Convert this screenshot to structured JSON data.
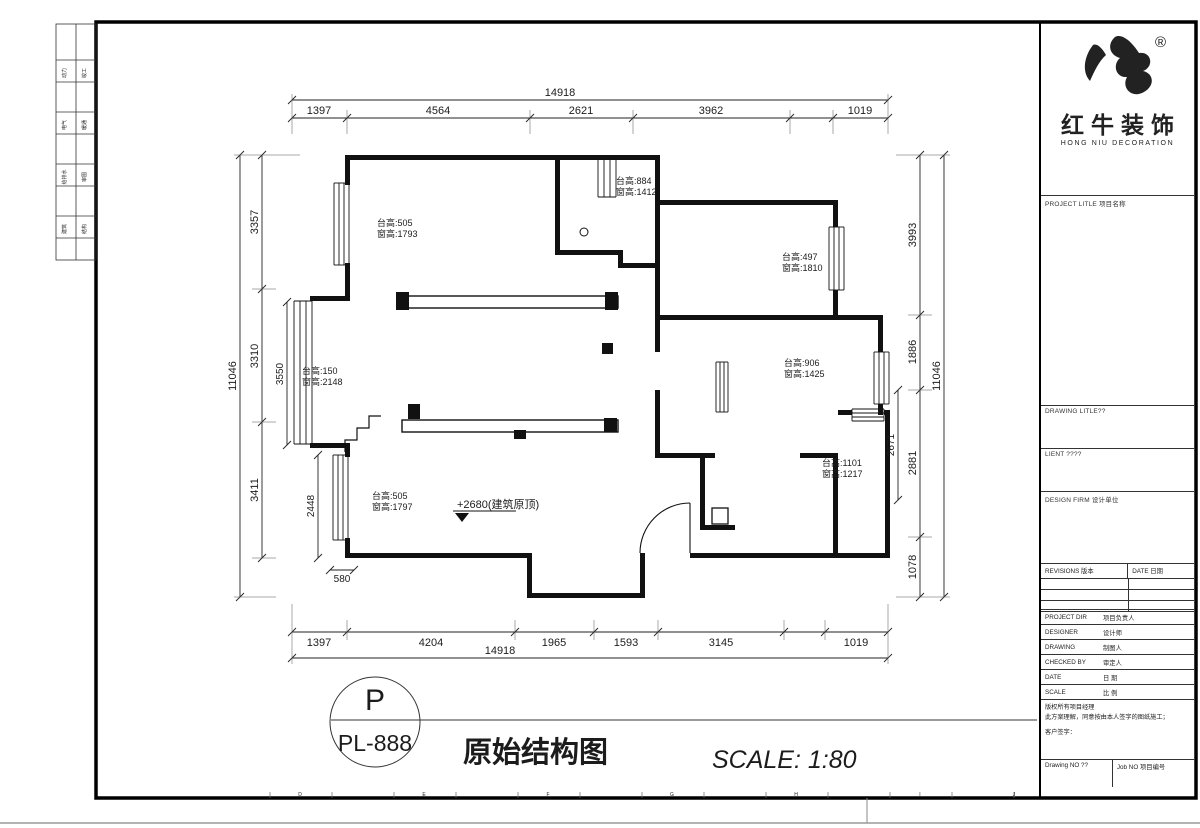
{
  "plan": {
    "dims": {
      "top_total": "14918",
      "top": [
        "1397",
        "4564",
        "2621",
        "3962",
        "1019"
      ],
      "bottom": [
        "1397",
        "4204",
        "1965",
        "1593",
        "3145",
        "1019"
      ],
      "bottom_total": "14918",
      "left_total": "11046",
      "left": [
        "3357",
        "3310",
        "3411"
      ],
      "left_inner_3550": "3550",
      "left_inner_2448": "2448",
      "left_inner_580": "580",
      "right_total": "11046",
      "right": [
        "3993",
        "1886",
        "2881",
        "1078"
      ],
      "right_inner_2671": "2671"
    },
    "notes": [
      {
        "l1": "台高:505",
        "l2": "窗高:1793"
      },
      {
        "l1": "台高:884",
        "l2": "窗高:1412"
      },
      {
        "l1": "台高:497",
        "l2": "窗高:1810"
      },
      {
        "l1": "台高:150",
        "l2": "窗高:2148"
      },
      {
        "l1": "台高:906",
        "l2": "窗高:1425"
      },
      {
        "l1": "台高:1101",
        "l2": "窗高:1217"
      },
      {
        "l1": "台高:505",
        "l2": "窗高:1797"
      }
    ],
    "level_note": "+2680(建筑原顶)"
  },
  "footer": {
    "circle_top": "P",
    "circle_code": "PL-888",
    "drawing_name": "原始结构图",
    "scale_text": "SCALE: 1:80"
  },
  "ruler_letters": [
    "D",
    "E",
    "F",
    "G",
    "H",
    "I",
    "J"
  ],
  "strip_labels": [
    [
      "动力",
      "竣工"
    ],
    [
      "电气",
      "暖通"
    ],
    [
      "给排水",
      "审图"
    ],
    [
      "建筑",
      "结构"
    ]
  ],
  "logo": {
    "reg": "®",
    "brand": "红牛装饰",
    "subtitle": "HONG NIU DECORATION"
  },
  "titleblock": {
    "project_label": "PROJECT LITLE 项目名称",
    "drawing_label": "DRAWING LITLE??",
    "client_label": "LIENT ????",
    "firm_label": "DESIGN FIRM 设计单位",
    "revisions_label": "REVISIONS 版本",
    "revisions_date_label": "DATE 日期",
    "rows": [
      {
        "en": "PROJECT DIR",
        "cn": "项目负责人"
      },
      {
        "en": "DESIGNER",
        "cn": "设计师"
      },
      {
        "en": "DRAWING",
        "cn": "制图人"
      },
      {
        "en": "CHECKED BY",
        "cn": "审定人"
      },
      {
        "en": "DATE",
        "cn": "日 期"
      },
      {
        "en": "SCALE",
        "cn": "比 例"
      }
    ],
    "copyright1": "版权所有项目经理",
    "copyright2": "此方案理解，同意按由本人签字的图纸施工；",
    "sign_label": "客户签字：",
    "drawing_no": "Drawing NO ??",
    "job_no": "Job NO 项目编号"
  }
}
